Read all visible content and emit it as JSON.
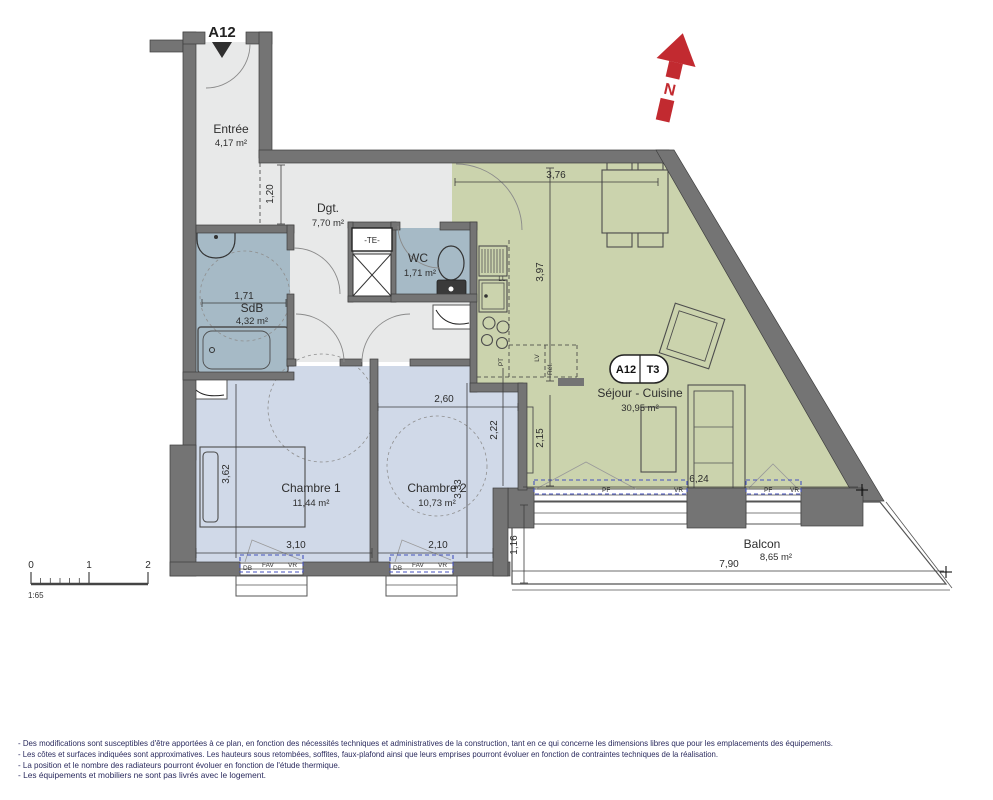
{
  "plan": {
    "unit": "A12",
    "north": "N",
    "badge": {
      "unit": "A12",
      "type": "T3"
    },
    "rooms": {
      "entree": {
        "name": "Entrée",
        "area": "4,17 m²"
      },
      "dgt": {
        "name": "Dgt.",
        "area": "7,70 m²"
      },
      "wc": {
        "name": "WC",
        "area": "1,71 m²"
      },
      "sdb": {
        "name": "SdB",
        "area": "4,32 m²"
      },
      "chambre1": {
        "name": "Chambre 1",
        "area": "11,44 m²"
      },
      "chambre2": {
        "name": "Chambre 2",
        "area": "10,73 m²"
      },
      "sejour": {
        "name": "Séjour - Cuisine",
        "area": "30,95 m²"
      },
      "balcon": {
        "name": "Balcon",
        "area": "8,65 m²"
      }
    },
    "dims": {
      "hall": "1,20",
      "sejour_top": "3,76",
      "kitchen": "3,97",
      "nook": "2,15",
      "sdb": "1,71",
      "ch2_top": "2,60",
      "ch2_right": "2,22",
      "ch1_left": "3,62",
      "ch2_left": "3,33",
      "ch1_w": "3,10",
      "ch2_w": "2,10",
      "sejour_bottom": "6,24",
      "balcon_d": "1,16",
      "balcon_w": "7,90"
    },
    "tech": {
      "te": "-TE-",
      "ll": "LL",
      "pt": "PT",
      "lv": "LV",
      "ref": "Réf."
    },
    "win": {
      "db": "DB",
      "fav": "FAV",
      "vr": "VR",
      "pf": "PF"
    },
    "scale": {
      "t0": "0",
      "t1": "1",
      "t2": "2",
      "ratio": "1:65"
    }
  },
  "colors": {
    "wall": "#747474",
    "hall_floor": "#e8e9e9",
    "wet_floor": "#a6bac6",
    "bedroom_floor": "#d0d9e8",
    "living_floor": "#cbd3ad",
    "north_red": "#c22a30",
    "window_dash_blue": "#4452bd"
  },
  "footnotes": [
    "- Des modifications sont susceptibles d'être apportées à ce plan, en fonction des nécessités techniques et administratives de la construction, tant en ce qui concerne les dimensions libres que pour les emplacements des équipements.",
    "- Les côtes et surfaces indiquées sont approximatives. Les hauteurs sous retombées, soffites, faux-plafond ainsi que leurs emprises pourront évoluer en fonction de contraintes techniques de la réalisation.",
    "- La position et le nombre des radiateurs pourront évoluer en fonction de l'étude thermique.",
    "- Les équipements et mobiliers ne sont pas livrés avec le logement."
  ]
}
